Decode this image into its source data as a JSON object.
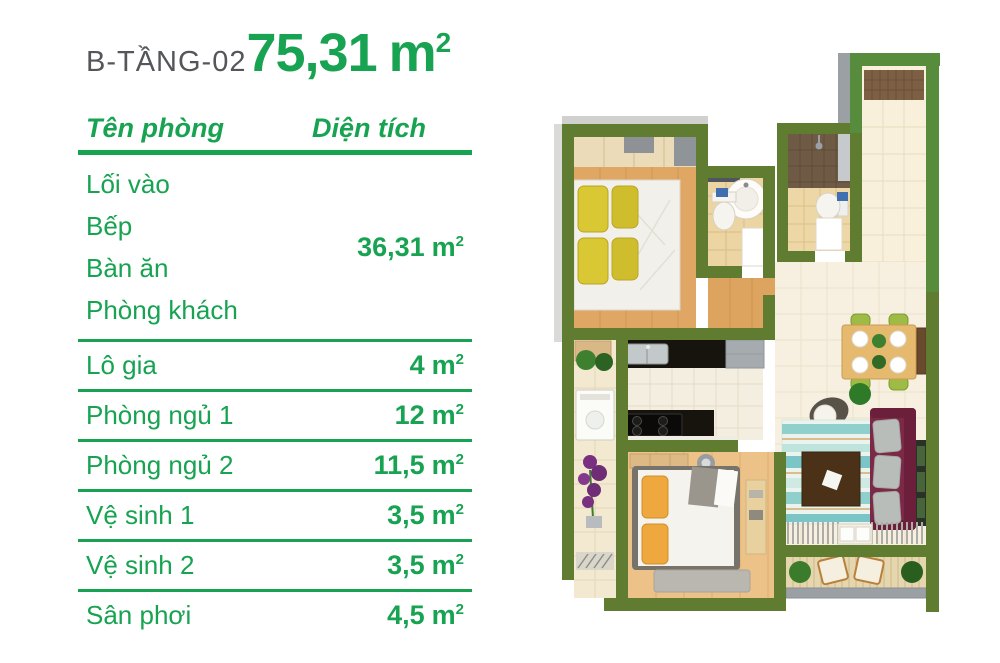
{
  "title": {
    "block": "B-TẦNG-02",
    "area_value": "75,31",
    "unit": "m",
    "unit_sup": "2"
  },
  "table": {
    "col_room": "Tên phòng",
    "col_area": "Diện tích",
    "unit": "m",
    "unit_sup": "2",
    "group": {
      "rooms": [
        "Lối vào",
        "Bếp",
        "Bàn ăn",
        "Phòng khách"
      ],
      "area_value": "36,31"
    },
    "rows": [
      {
        "name": "Lô gia",
        "area_value": "4"
      },
      {
        "name": "Phòng ngủ 1",
        "area_value": "12"
      },
      {
        "name": "Phòng ngủ 2",
        "area_value": "11,5"
      },
      {
        "name": "Vệ sinh 1",
        "area_value": "3,5"
      },
      {
        "name": "Vệ sinh 2",
        "area_value": "3,5"
      },
      {
        "name": "Sân phơi",
        "area_value": "4,5"
      }
    ]
  },
  "colors": {
    "accent_green": "#17a351",
    "title_gray": "#54565a",
    "wall_olive": "#5f7c31",
    "wall_bright": "#578c3c",
    "wood_floor": "#dfa763",
    "tile_cream": "#f7f0e0",
    "tile_bath": "#ecd5a2",
    "counter_black": "#17140e",
    "sofa_maroon": "#7c2847",
    "rug_teal": "#7cc5c6"
  }
}
